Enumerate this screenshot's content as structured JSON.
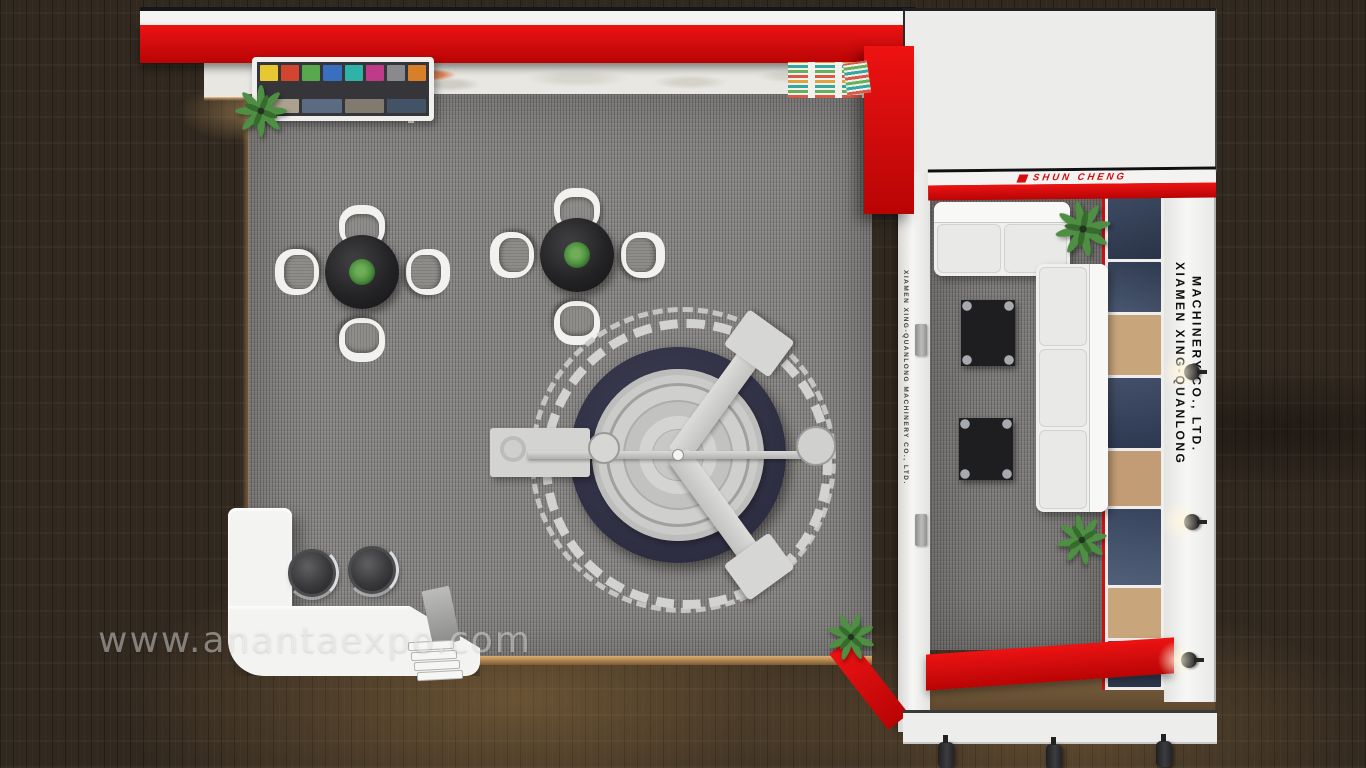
{
  "scene": {
    "description": "Top-down 3D render of a red and white L-shaped exhibition booth with lounge area, central machine display and reception counter",
    "watermark_text": "www.anantaexpo.com"
  },
  "branding": {
    "fascia_text": "SHUN CHENG",
    "company_line1": "XIAMEN XING-QUANLONG",
    "company_line2": "MACHINERY CO., LTD.",
    "divider_text": "XIAMEN XING-QUANLONG MACHINERY CO., LTD."
  },
  "colors": {
    "booth_red": "#d40d0d",
    "carpet_gray": "#8a8886",
    "wood_floor_brown": "#31281f",
    "wall_white": "#f1f1ef",
    "machine_navy": "#323246",
    "plant_green": "#4e8f43",
    "counter_white": "#f3f3f1"
  }
}
